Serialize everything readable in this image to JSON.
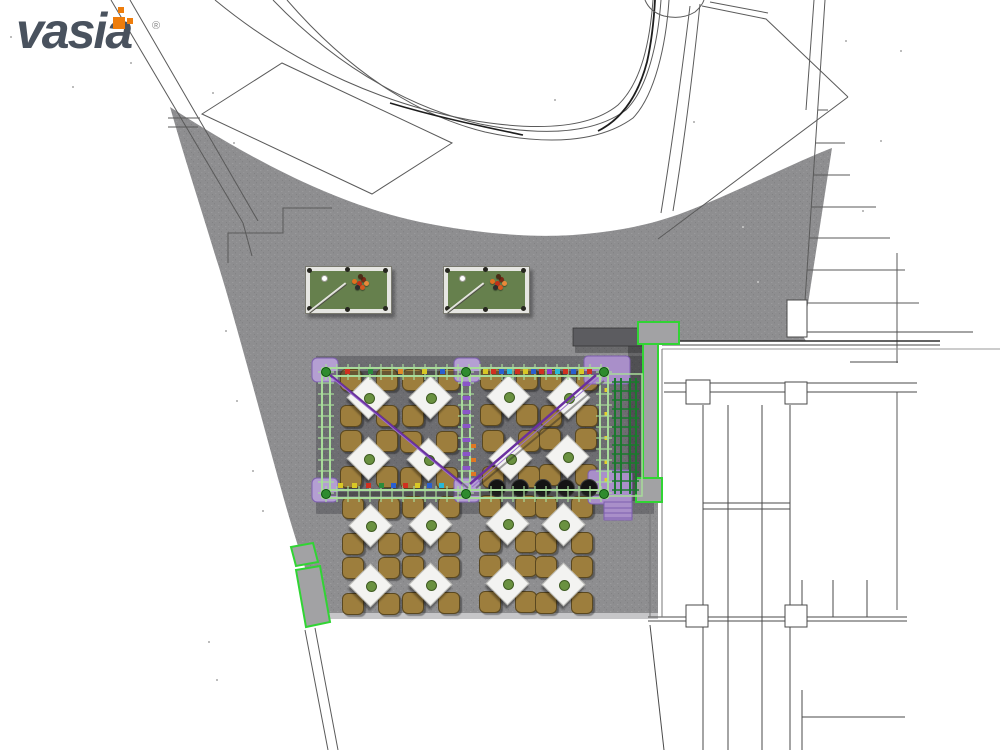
{
  "logo": {
    "text": "vasia",
    "registered_mark": "®",
    "wordmark_color": "#49525e",
    "accent_color": "#ee7d0c"
  },
  "palette": {
    "plaza": "#8e8e90",
    "plaza_edge": "#c6c6c8",
    "cad_line": "#4a4a4a",
    "shadow": "rgba(22,22,28,0.27)",
    "highlight_green": "#31d434",
    "frame_green": "#a8dc9a",
    "junction_green": "#2e8b2e",
    "trellis_green": "#1a7a2d",
    "post_purple": "#b49fd2",
    "platform_purple": "#a98fc9",
    "post_purple_border": "#7d5fae",
    "brace_purple": "#6a2fa0",
    "wall_gray": "#a2a2a4",
    "bar_gray": "#5c5c60",
    "table_top": "#f3f3f1",
    "chair": "#9d7e3d",
    "chair_border": "#5a4820",
    "plant": "#6a9140",
    "pool_rail": "#e6e6e2",
    "pool_felt": "#66804d",
    "stool_black": "#141414"
  },
  "scene": {
    "pool_tables": [
      {
        "x": 305,
        "y": 266
      },
      {
        "x": 443,
        "y": 266
      }
    ],
    "pool_detail": {
      "width": 85,
      "height": 46,
      "ball_colors": [
        "#e07020",
        "#c23018",
        "#7a2814",
        "#2e2e2e",
        "#d4581f",
        "#e8893a",
        "#4a2d16"
      ],
      "ball_offsets": [
        [
          46,
          12
        ],
        [
          51,
          14
        ],
        [
          55,
          10
        ],
        [
          49,
          18
        ],
        [
          54,
          18
        ],
        [
          58,
          14
        ],
        [
          52,
          7
        ]
      ],
      "cue_ball": [
        15,
        8
      ]
    },
    "tables_inside": [
      [
        368,
        397
      ],
      [
        430,
        397
      ],
      [
        508,
        396
      ],
      [
        568,
        397
      ],
      [
        368,
        458
      ],
      [
        428,
        459
      ],
      [
        510,
        458
      ],
      [
        567,
        456
      ]
    ],
    "tables_outside": [
      [
        370,
        525
      ],
      [
        430,
        524
      ],
      [
        507,
        523
      ],
      [
        563,
        524
      ],
      [
        370,
        585
      ],
      [
        430,
        584
      ],
      [
        507,
        583
      ],
      [
        563,
        584
      ]
    ],
    "stools": {
      "y": 488,
      "xs": [
        497,
        520,
        543,
        566,
        589
      ],
      "r": 8.5
    },
    "pergola": {
      "frame": {
        "x1": 322,
        "x2": 608,
        "y1": 368,
        "y2": 490,
        "mid_x": 462
      },
      "pads": [
        [
          312,
          358
        ],
        [
          454,
          358
        ],
        [
          312,
          478
        ],
        [
          454,
          478
        ]
      ],
      "platforms": [
        {
          "x": 584,
          "y": 356,
          "w": 46,
          "h": 28
        },
        {
          "x": 588,
          "y": 470,
          "w": 44,
          "h": 34
        }
      ],
      "stairs": {
        "x": 604,
        "y": 502,
        "w": 28,
        "h": 18
      },
      "braces": [
        {
          "x1": 330,
          "y1": 375,
          "x2": 462,
          "y2": 484
        },
        {
          "x1": 596,
          "y1": 375,
          "x2": 470,
          "y2": 484
        }
      ],
      "accent_dashes_top": [
        [
          345,
          "#d03020"
        ],
        [
          368,
          "#2a8a3a"
        ],
        [
          398,
          "#e08a28"
        ],
        [
          422,
          "#d8c825"
        ],
        [
          440,
          "#2a5fd0"
        ],
        [
          483,
          "#d8c825"
        ],
        [
          491,
          "#d03020"
        ],
        [
          499,
          "#2a5fd0"
        ],
        [
          507,
          "#28b8d8"
        ],
        [
          515,
          "#d03020"
        ],
        [
          523,
          "#d8c825"
        ],
        [
          531,
          "#2a5fd0"
        ],
        [
          539,
          "#d03020"
        ],
        [
          547,
          "#8a3ad0"
        ],
        [
          555,
          "#28b8d8"
        ],
        [
          563,
          "#d03020"
        ],
        [
          571,
          "#2a5fd0"
        ],
        [
          579,
          "#d8c825"
        ],
        [
          587,
          "#d03020"
        ]
      ],
      "accent_dashes_bottom": [
        [
          338,
          "#d8c825"
        ],
        [
          352,
          "#d8c825"
        ],
        [
          366,
          "#d03020"
        ],
        [
          379,
          "#2a8a3a"
        ],
        [
          391,
          "#2a5fd0"
        ],
        [
          403,
          "#d03020"
        ],
        [
          415,
          "#d8c825"
        ],
        [
          427,
          "#2a5fd0"
        ],
        [
          439,
          "#28b8d8"
        ]
      ],
      "mid_post_dashes_y": [
        382,
        396,
        410,
        424,
        438,
        452,
        466
      ],
      "mid_post_orange_y": [
        444,
        458,
        472
      ],
      "trellis": {
        "x": 608,
        "y": 374,
        "w": 34,
        "h": 122,
        "rail_xs": [
          615,
          621,
          630,
          636
        ],
        "yellow_y": [
          388,
          412,
          436,
          460,
          478
        ]
      }
    },
    "benches": [
      {
        "points": "291,547 313,543 318,562 296,566"
      },
      {
        "points": "296,570 320,566 330,622 306,627"
      }
    ],
    "green_wall": [
      {
        "x": 638,
        "y": 322,
        "w": 41,
        "h": 22
      },
      {
        "x": 643,
        "y": 344,
        "w": 15,
        "h": 136
      },
      {
        "x": 636,
        "y": 478,
        "w": 26,
        "h": 24
      }
    ],
    "dark_bar": {
      "x": 573,
      "y": 328,
      "w": 69,
      "h": 18
    },
    "plaza_column": {
      "x": 787,
      "y": 300,
      "w": 20,
      "h": 37
    }
  }
}
